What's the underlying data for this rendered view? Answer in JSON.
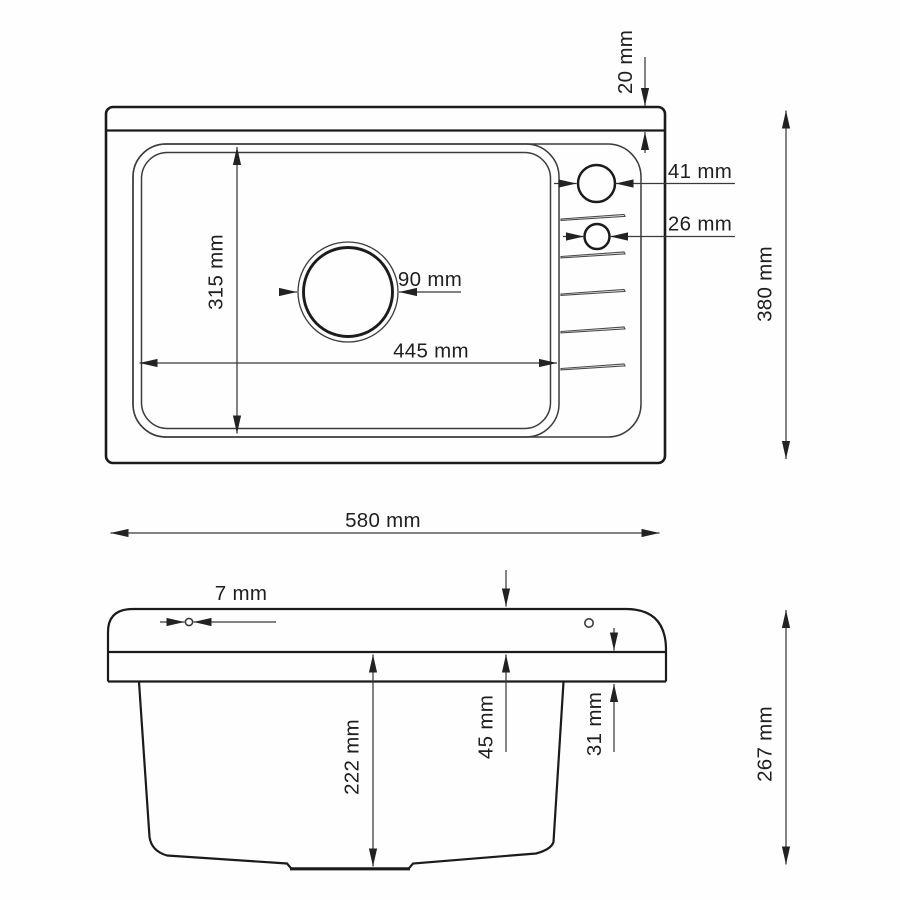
{
  "diagram": {
    "top_view": {
      "dimensions": {
        "front_rim_depth": "20 mm",
        "tap_hole_large_diameter": "41 mm",
        "tap_hole_small_diameter": "26 mm",
        "drain_hole_diameter": "90 mm",
        "bowl_length": "445 mm",
        "bowl_width": "315 mm",
        "overall_depth": "380 mm",
        "overall_width": "580 mm"
      }
    },
    "side_view": {
      "dimensions": {
        "rim_hole_diameter": "7 mm",
        "rim_height": "45 mm",
        "edge_height": "31 mm",
        "bowl_depth": "222 mm",
        "overall_height": "267 mm"
      }
    }
  }
}
